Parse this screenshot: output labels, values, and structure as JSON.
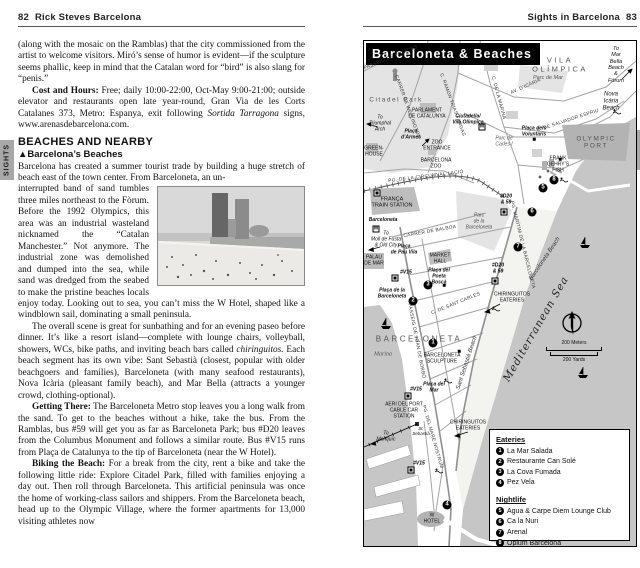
{
  "left_page": {
    "header": {
      "page_num": "82",
      "title": "Rick Steves Barcelona"
    },
    "sights_tab": "SIGHTS",
    "para_intro": "(along with the mosaic on the Ramblas) that the city commissioned from the artist to welcome visitors. Miró’s sense of humor is evident—if the sculpture seems phallic, keep in mind that the Catalan word for “bird” is also slang for “penis.”",
    "cost_label": "Cost and Hours:",
    "cost_text": " Free; daily 10:00-22:00, Oct-May 9:00-21:00; outside elevator and restaurants open late year-round, Gran Via de les Corts Catalanes 373, Metro: Espanya, exit following ",
    "cost_italic": "Sortida Tarragona",
    "cost_tail": " signs, www.arenasdebarcelona.com.",
    "section_heading": "BEACHES AND NEARBY",
    "sub_heading": "▲Barcelona’s Beaches",
    "beaches_p1a": "Barcelona has created a summer tourist trade by building a huge stretch of beach east of the town center. From Barceloneta, an un-",
    "beaches_p1b": "interrupted band of sand tumbles three miles northeast to the Fòrum. Before the 1992 Olympics, this area was an industrial wasteland nicknamed the “Catalan Manchester.” Not anymore. The industrial zone was demolished and dumped into the sea, while sand was dredged from the seabed to make the pristine beaches locals enjoy today. Looking out to sea, you can’t miss the W Hotel, shaped like a windblown sail, dominating a small peninsula.",
    "p2_text": "The overall scene is great for sunbathing and for an evening paseo before dinner. It’s like a resort island—complete with lounge chairs, volleyball, showers, WCs, bike paths, and inviting beach bars called ",
    "p2_italic": "chiringuitos.",
    "p2_rest": " Each beach segment has its own vibe: Sant Sebastià (closest, popular with older beachgoers and families), Barceloneta (with many seafood restaurants), Nova Icària (pleasant family beach), and Mar Bella (attracts a younger crowd, clothing-optional).",
    "p3_label": "Getting There:",
    "p3_text": " The Barceloneta Metro stop leaves you a long walk from the sand. To get to the beaches without a hike, take the bus. From the Ramblas, bus #59 will get you as far as Barceloneta Park; bus #D20 leaves from the Columbus Monument and follows a similar route. Bus #V15 runs from Plaça de Catalunya to the tip of Barceloneta (near the W Hotel).",
    "p4_label": "Biking the Beach:",
    "p4_text": " For a break from the city, rent a bike and take the following little ride: Explore Citadel Park, filled with families enjoying a day out. Then roll through Barceloneta. This artificial peninsula was once the home of working-class sailors and shippers. From the Barceloneta beach, head up to the Olympic Village, where the former apartments for 13,000 visiting athletes now"
  },
  "right_page": {
    "header": {
      "title": "Sights in Barcelona",
      "page_num": "83"
    },
    "sights_tab": "SIGHTS",
    "map": {
      "title": "Barceloneta & Beaches",
      "labels": {
        "vila_olimpica": "VILA\nOLÍMPICA",
        "to_mar_bella": "To\nMar Bella\nBeach\n& Fòrum",
        "parc_de_mar": "Parc de Mar",
        "nova_icaria": "Nova\nIcària\nBeach",
        "olympic_port": "OLYMPIC\nPORT",
        "placa_voluntaris": "Plaça dels\nVoluntaris",
        "parc_carles": "Parc de\nCarles I",
        "gehry_fish": "FRANK\nGEHRY’S\nFISH",
        "citadel_park": "Citadel Park",
        "parlament": "PARLAMENT\nDE CATALUNYA",
        "to_triumphal": "To\nTriumphal\nArch",
        "placa_armes": "Plaça\nd’Armes",
        "zoo_entrance": "ZOO\nENTRANCE",
        "greenhouse": "GREEN-\nHOUSE",
        "barcelona_zoo": "BARCELONA\nZOO",
        "ciutadella_metro": "Ciutadella/\nVila Olímpica",
        "franca_station": "FRANÇA\nTRAIN STATION",
        "barceloneta_metro": "Barceloneta",
        "to_moll": "To\nMoll de Fusta\n& Old City",
        "palau_de_mar": "PALAU\nDE MAR",
        "pau_vila": "Plaça\nde Pau Vila",
        "market_hall": "MARKET\nHALL",
        "poeta_bosca": "Plaça del\nPoeta\nBoscà",
        "placa_barceloneta": "Plaça de la\nBarceloneta",
        "parc_barceloneta": "Parc\nde la\nBarceloneta",
        "district": "BARCELONETA",
        "marina": "Marina",
        "sculpture": "BARCELONETA\nSCULPTURE",
        "placa_mar": "Plaça del\nMar",
        "aeri": "AERI DEL PORT\nCABLE CAR\nSTATION",
        "torre_sebastia": "St.\nSebastià",
        "to_montjuic": "To\nMontjuïc",
        "w_hotel": "W\nHOTEL",
        "chiringuitos": "CHIRINGUITOS\nEATERIES",
        "beach_barceloneta": "Barceloneta Beach",
        "beach_sant_sebastia": "Sant Sebastià Beach",
        "sea": "Mediterranean Sea"
      },
      "streets": {
        "pujades": "PASSEIG DE PUJADES",
        "wellington": "CARRER DE WELLINGTON",
        "trias": "C. RAMON TRIAS FARGAS",
        "marina_st": "C. DE LA MARINA",
        "icaria": "AV. D’ICÀRIA",
        "espriu": "C. DE SALVADOR ESPRIU",
        "circumvallacio": "PG. DE LA CIRCUMVAL·LACIÓ",
        "balboa": "CARRER DE BALBOA",
        "borbo": "PASSEIG DE JOAN DE BORBÓ",
        "maritim": "PG. MARÍTIM DE LA BARCELONETA",
        "mare_nostrum": "PG. DEL MARE NOSTRUM",
        "sant_carles": "C. DE SANT CARLES"
      },
      "transit": {
        "bus_d20": "#D20\n& 59",
        "bus_v15": "#V15",
        "metro_letter": "M"
      },
      "scale": {
        "meters": "200 Meters",
        "yards": "200 Yards"
      },
      "legend": {
        "eateries_title": "Eateries",
        "eateries": [
          {
            "num": "1",
            "name": "La Mar Salada"
          },
          {
            "num": "2",
            "name": "Restaurante Can Solé"
          },
          {
            "num": "3",
            "name": "La Cova Fumada"
          },
          {
            "num": "4",
            "name": "Pez Vela"
          }
        ],
        "nightlife_title": "Nightlife",
        "nightlife": [
          {
            "num": "5",
            "name": "Agua & Carpe Diem Lounge Club"
          },
          {
            "num": "6",
            "name": "Ca la Nuri"
          },
          {
            "num": "7",
            "name": "Arenal"
          },
          {
            "num": "8",
            "name": "Opium Barcelona"
          }
        ]
      }
    }
  },
  "colors": {
    "sea": "#c6c6c6",
    "park": "#e4e4e4",
    "building": "#bdbdbd",
    "tab": "#a8a8a8",
    "title_bg": "#000000"
  }
}
